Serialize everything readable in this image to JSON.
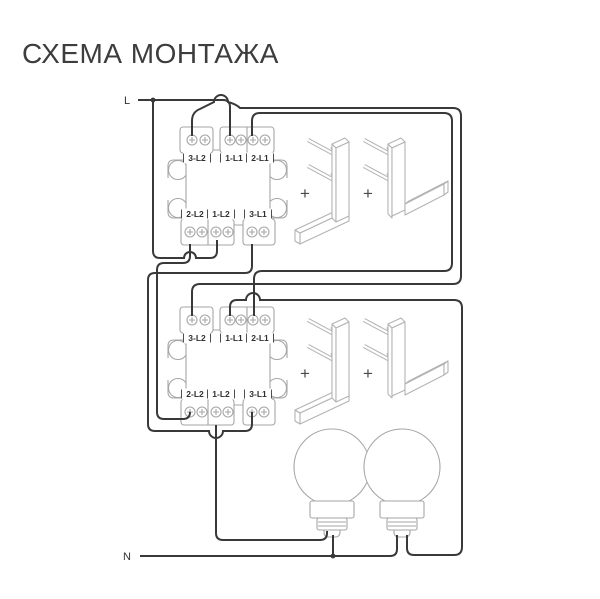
{
  "title": "СХЕМА МОНТАЖА",
  "power": {
    "line_label": "L",
    "neutral_label": "N"
  },
  "switches": [
    {
      "name": "switch-1",
      "terminals_top": [
        "3-L2",
        "1-L1",
        "2-L1"
      ],
      "terminals_bottom": [
        "2-L2",
        "1-L2",
        "3-L1"
      ]
    },
    {
      "name": "switch-2",
      "terminals_top": [
        "3-L2",
        "1-L1",
        "2-L1"
      ],
      "terminals_bottom": [
        "2-L2",
        "1-L2",
        "3-L1"
      ]
    }
  ],
  "keys": {
    "plus_sign": "+"
  },
  "lamps": {
    "count": "2"
  },
  "colors": {
    "wire": "#393939",
    "component_outline": "#a6a6a6",
    "label_text": "#2f2f2f"
  }
}
